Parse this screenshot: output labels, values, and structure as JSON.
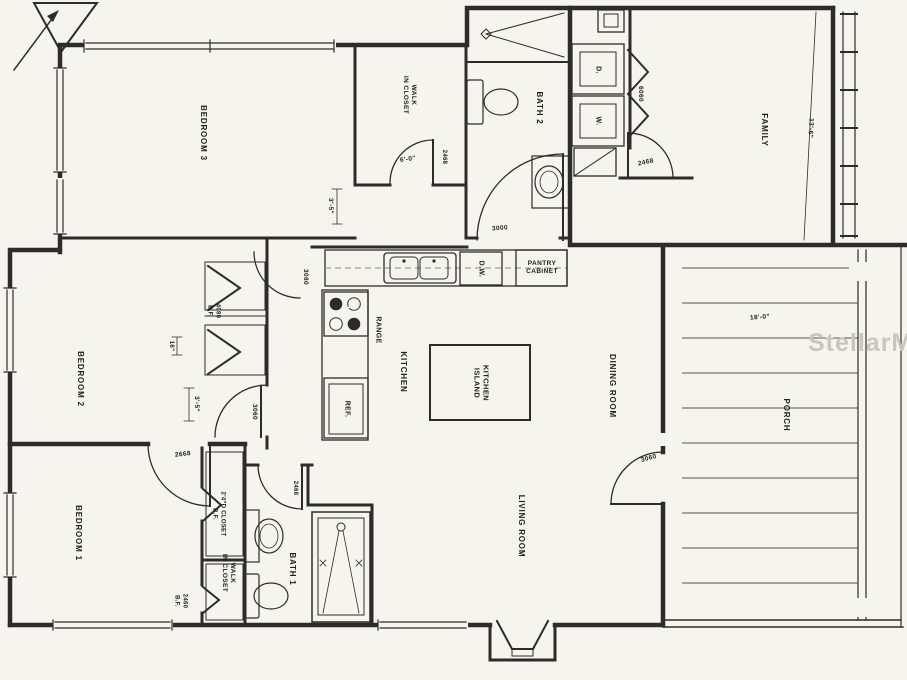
{
  "plan": {
    "watermark": "StellarMLS",
    "colors": {
      "paper": "#f6f4ef",
      "ink": "#2e2c2a",
      "watermark": "#c9c6c0"
    },
    "icons": {
      "compass": "north-arrow"
    },
    "rooms": {
      "bedroom3": "BEDROOM 3",
      "bedroom2": "BEDROOM 2",
      "bedroom1": "BEDROOM 1",
      "family": "FAMILY",
      "kitchen": "KITCHEN",
      "dining": "DINING ROOM",
      "living": "LIVING ROOM",
      "porch": "PORCH",
      "bath1": "BATH 1",
      "bath2": "BATH 2",
      "walk_in_closet_top": "WALK\nIN CLOSET",
      "walk_in_closet_bottom": "WALK\nIN CLOSET",
      "closet_b1": "2'4\"D CLOSET\nB.F."
    },
    "fixtures": {
      "kitchen_island": "KITCHEN\nISLAND",
      "pantry": "PANTRY\nCABINET",
      "dishwasher": "D.W.",
      "dryer": "D.",
      "washer": "W.",
      "range": "RANGE",
      "microwave": "M/W",
      "fridge": "REF."
    },
    "dimensions": {
      "family_width": "13'-6\"",
      "porch_width": "18'-0\"",
      "hall_closet": "3'-5\"",
      "bedroom2_wall": "3'-5\"",
      "closet_depth": "16\"",
      "wic_width": "6'-0\""
    },
    "doors": {
      "hall_opening": "3000",
      "kitchen_opening": "3080",
      "wic_top_door": "2468",
      "family_door": "2468",
      "bath1_door": "2468",
      "laundry_bifold": "6060",
      "bedroom2_door": "3060",
      "porch_door": "3060",
      "bedroom1_door": "2668",
      "b2_closet_bifold": "4080\nB.F.",
      "b1_wic_bifold": "2460\nB.F."
    }
  }
}
